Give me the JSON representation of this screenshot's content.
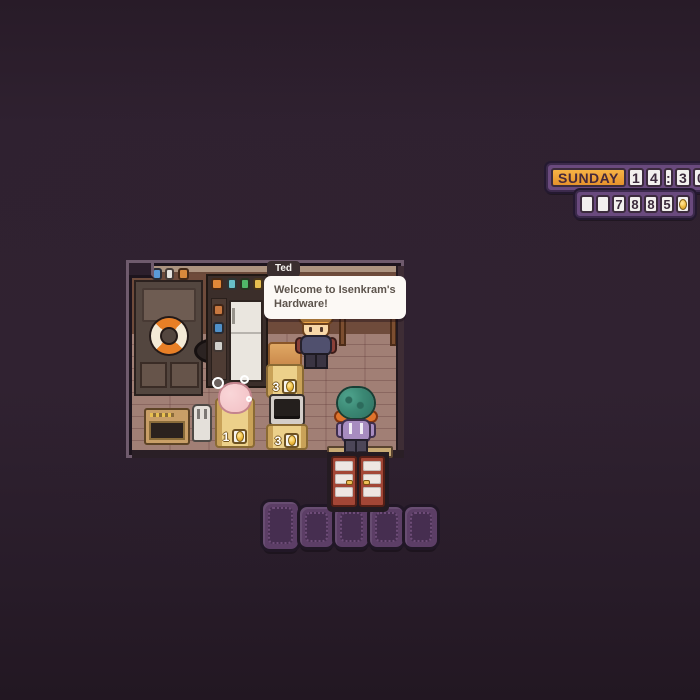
{
  "hud": {
    "day_label": "SUNDAY",
    "time": "14:30",
    "time_cells": [
      "1",
      "4",
      ":",
      "3",
      "0"
    ],
    "money": "7885",
    "money_digits": [
      "7",
      "8",
      "8",
      "5"
    ],
    "coin_icon": "gold-coin"
  },
  "dialogue": {
    "speaker": "Ted",
    "line1": "Welcome to Isenkram's",
    "line2": "Hardware!"
  },
  "shop": {
    "displays": [
      {
        "item": "plush-pig-with-bubbles",
        "price": "1",
        "currency_icon": "gold-coin"
      },
      {
        "item": "orange-cabinet",
        "price": "3",
        "currency_icon": "gold-coin"
      },
      {
        "item": "monitor-machine",
        "price": "3",
        "currency_icon": "gold-coin"
      }
    ],
    "characters": [
      {
        "name": "Ted",
        "role": "shopkeeper"
      },
      {
        "name": "player",
        "role": "customer"
      }
    ]
  },
  "colors": {
    "background": "#2e2030",
    "hud_panel": "#6a4a7e",
    "hud_panel_border": "#3c2a4c",
    "day_badge_bg": "#f2a53b",
    "hud_cell_bg": "#f2f0ee",
    "hud_digit": "#3c2b3d",
    "coin_gold": "#f0bc3e",
    "path_tile": "#5c3e66",
    "store_floor": "#a17f75",
    "store_wall": "#6f4b3b",
    "door_red": "#a34636",
    "speech_bubble": "#fcf9f5"
  }
}
